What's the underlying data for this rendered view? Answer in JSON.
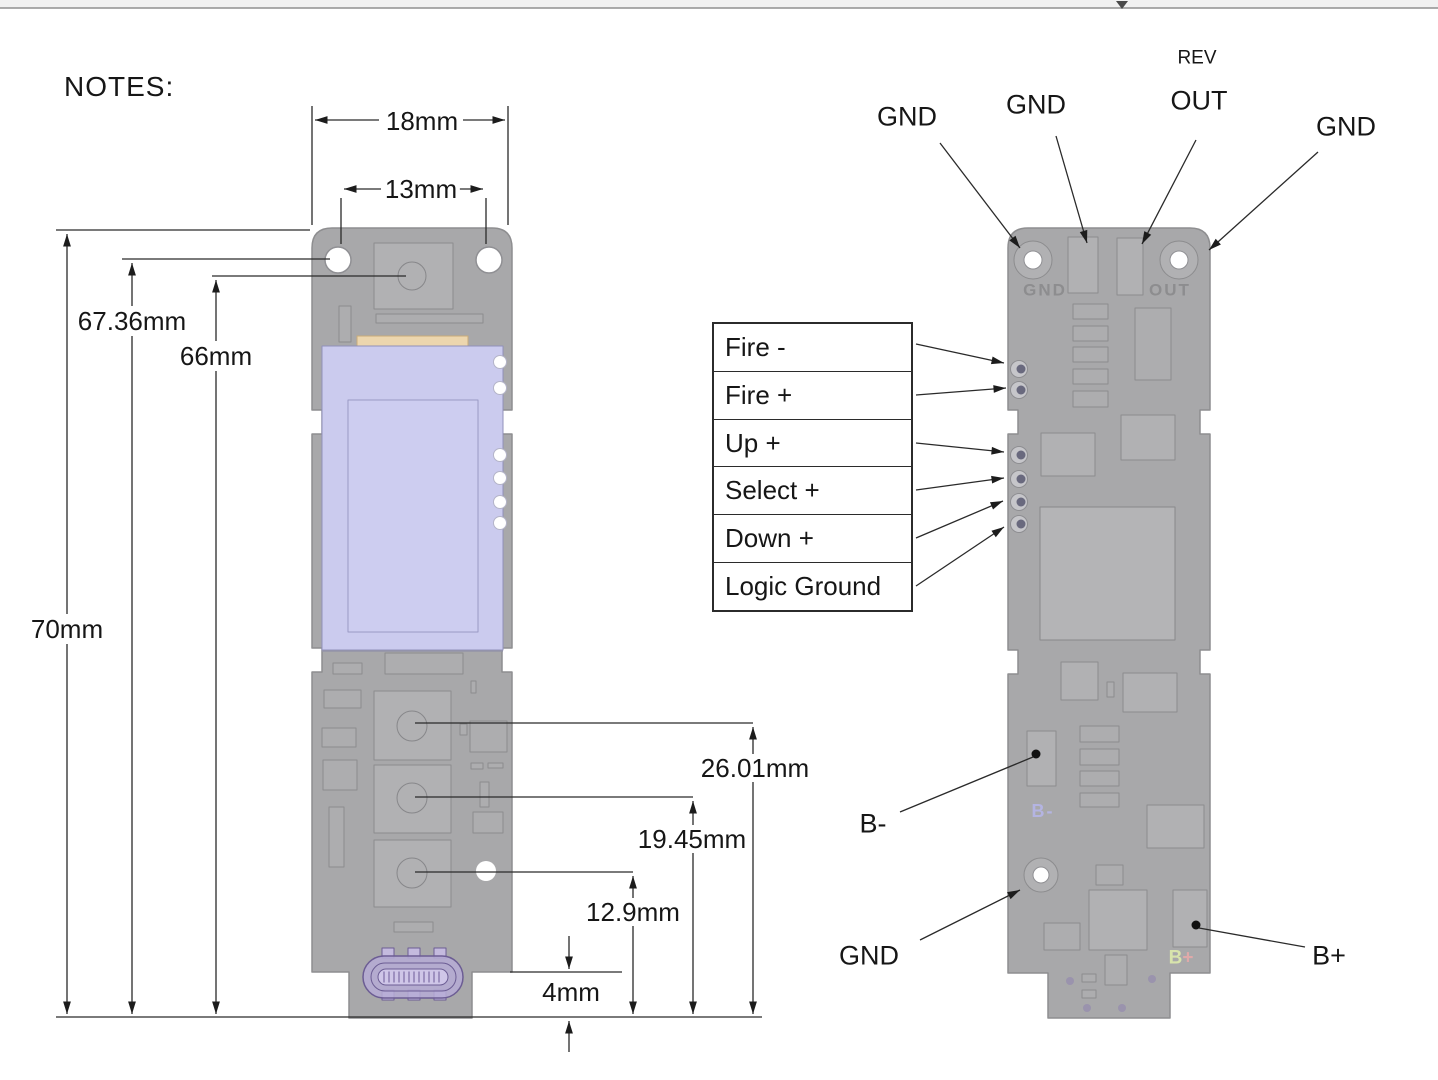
{
  "notes_label": "NOTES:",
  "dimensions": {
    "width_outer": "18mm",
    "width_holes": "13mm",
    "height_hole": "67.36mm",
    "height_button_top": "66mm",
    "height_total": "70mm",
    "height_btn1": "26.01mm",
    "height_btn2": "19.45mm",
    "height_btn3": "12.9mm",
    "height_usb": "4mm"
  },
  "right_view": {
    "top_labels": {
      "gnd_left": "GND",
      "gnd_mid": "GND",
      "rev": "REV",
      "out": "OUT",
      "gnd_right": "GND"
    },
    "pin_table": [
      "Fire -",
      "Fire +",
      "Up +",
      "Select +",
      "Down +",
      "Logic Ground"
    ],
    "bottom_labels": {
      "b_minus": "B-",
      "gnd": "GND",
      "b_plus": "B+"
    },
    "silkscreen": {
      "gnd": "GND",
      "out": "OUT",
      "b_minus": "B-",
      "b_plus_b": "B",
      "b_plus_sign": "+"
    }
  },
  "colors": {
    "board": "#a8a8aa",
    "component": "#b1b1b3",
    "display": "#cbcbee",
    "flex_connector": "#ecd6ae",
    "usb_connector": "#b6abd6",
    "line": "#222222",
    "silkscreen_gray": "#8d8d8f",
    "silk_b_minus": "#b4b4e2",
    "silk_b_plus": "#d8e4ac",
    "silk_plus": "#dfa9a9"
  }
}
